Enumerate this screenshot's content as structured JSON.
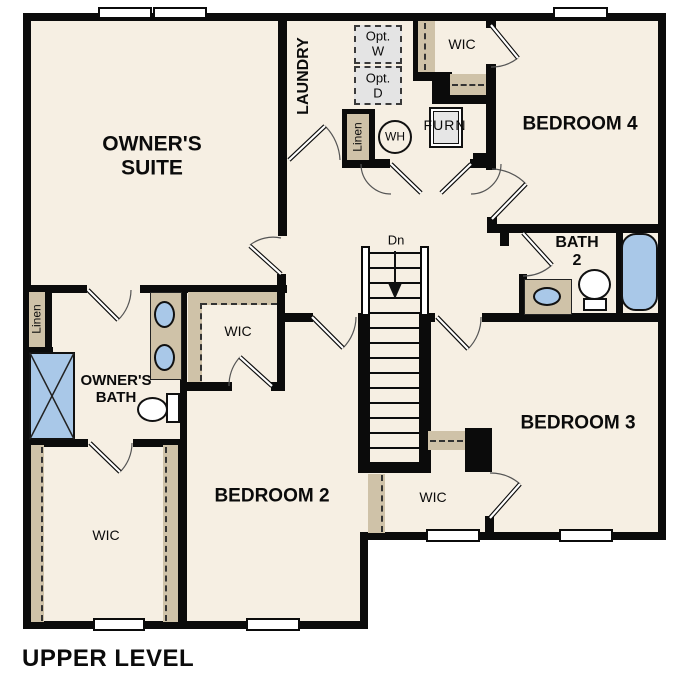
{
  "title": "UPPER LEVEL",
  "colors": {
    "floor": "#f6efe3",
    "wall": "#0b0b0b",
    "shelf_tan": "#cfc2a8",
    "fixture_blue": "#a9c8e8",
    "option_gray": "#e4e4e4"
  },
  "rooms": {
    "owners_suite": {
      "label": "OWNER'S\nSUITE"
    },
    "laundry": {
      "label": "LAUNDRY"
    },
    "bedroom2": {
      "label": "BEDROOM 2"
    },
    "bedroom3": {
      "label": "BEDROOM 3"
    },
    "bedroom4": {
      "label": "BEDROOM 4"
    },
    "bath2": {
      "label": "BATH\n2"
    },
    "owners_bath": {
      "label": "OWNER'S\nBATH"
    },
    "wic_top": {
      "label": "WIC"
    },
    "wic_middle": {
      "label": "WIC"
    },
    "wic_left": {
      "label": "WIC"
    },
    "wic_bedroom3": {
      "label": "WIC"
    }
  },
  "features": {
    "opt_washer": {
      "label": "Opt.\nW"
    },
    "opt_dryer": {
      "label": "Opt.\nD"
    },
    "water_heater": {
      "label": "WH"
    },
    "furnace": {
      "label": "FURN"
    },
    "linen_hall": {
      "label": "Linen"
    },
    "linen_bath": {
      "label": "Linen"
    },
    "stairs": {
      "label": "Dn"
    }
  }
}
